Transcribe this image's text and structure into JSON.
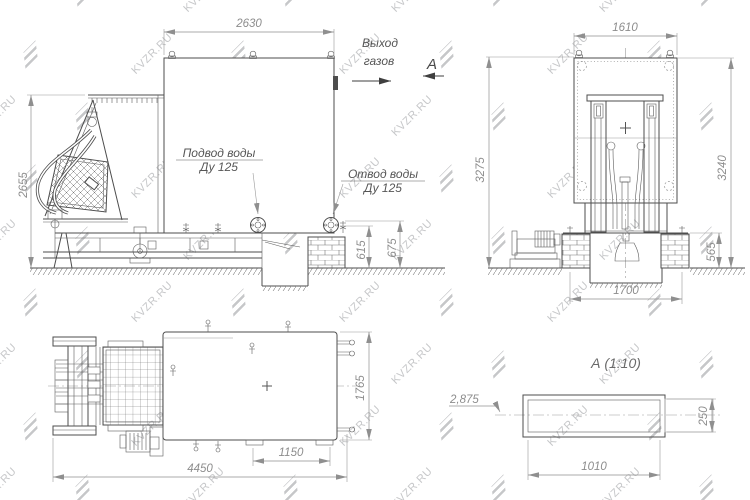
{
  "watermark": {
    "text": "KVZR.RU"
  },
  "side_view": {
    "dim_width": "2630",
    "dim_height": "2655",
    "dim_h1": "615",
    "dim_h2": "675",
    "label_inlet_1": "Подвод воды",
    "label_inlet_2": "Ду 125",
    "label_outlet_1": "Отвод воды",
    "label_outlet_2": "Ду 125",
    "label_gas_1": "Выход",
    "label_gas_2": "газов",
    "view_letter": "А"
  },
  "front_view": {
    "dim_width_top": "1610",
    "dim_height_left": "3275",
    "dim_height_right": "3240",
    "dim_width_bottom": "1700",
    "dim_pedestal": "565"
  },
  "plan_view": {
    "dim_length": "4450",
    "dim_l2": "1150",
    "dim_width": "1765"
  },
  "detail_view": {
    "title": "А (1:10)",
    "dim_length": "1010",
    "dim_height": "250",
    "dim_leader": "2,875"
  }
}
